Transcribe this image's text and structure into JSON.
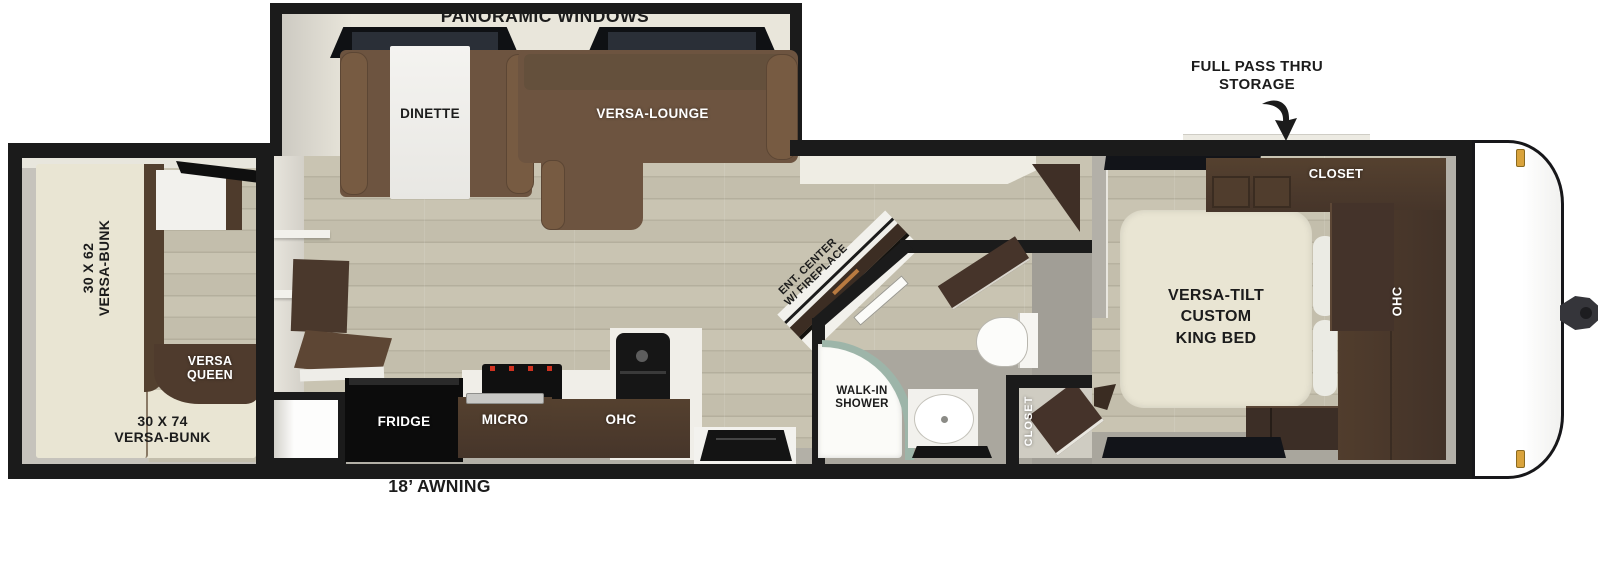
{
  "floorplan": {
    "slideout": {
      "panoramic_windows_label": "PANORAMIC WINDOWS",
      "dinette_label": "DINETTE",
      "versa_lounge_label": "VERSA-LOUNGE"
    },
    "living_kitchen": {
      "ent_center_label_line1": "ENT. CENTER",
      "ent_center_label_line2": "W/ FIREPLACE",
      "fridge_label": "FRIDGE",
      "micro_label": "MICRO",
      "ohc_label": "OHC"
    },
    "bathroom": {
      "shower_label_line1": "WALK-IN",
      "shower_label_line2": "SHOWER",
      "closet_label": "CLOSET"
    },
    "bedroom": {
      "bed_label_line1": "VERSA-TILT",
      "bed_label_line2": "CUSTOM",
      "bed_label_line3": "KING BED",
      "closet_label": "CLOSET",
      "ohc_label": "OHC",
      "pass_thru_label_line1": "FULL PASS THRU",
      "pass_thru_label_line2": "STORAGE"
    },
    "bunkroom": {
      "side_bunk_label_line1": "30 X 62",
      "side_bunk_label_line2": "VERSA-BUNK",
      "queen_label_line1": "VERSA",
      "queen_label_line2": "QUEEN",
      "rear_bunk_label_line1": "30 X 74",
      "rear_bunk_label_line2": "VERSA-BUNK"
    },
    "exterior": {
      "awning_label": "18’ AWNING"
    },
    "colors": {
      "outline": "#1b1b1b",
      "wood_floor": "#c8c3b1",
      "sofa_brown": "#6d5440",
      "cabinet_brown": "#4a382c",
      "mattress_cream": "#e9e5d3",
      "slide_interior": "#e9e6db",
      "shower_glass": "#9db5a9",
      "marker_light": "#d9a33c"
    }
  }
}
